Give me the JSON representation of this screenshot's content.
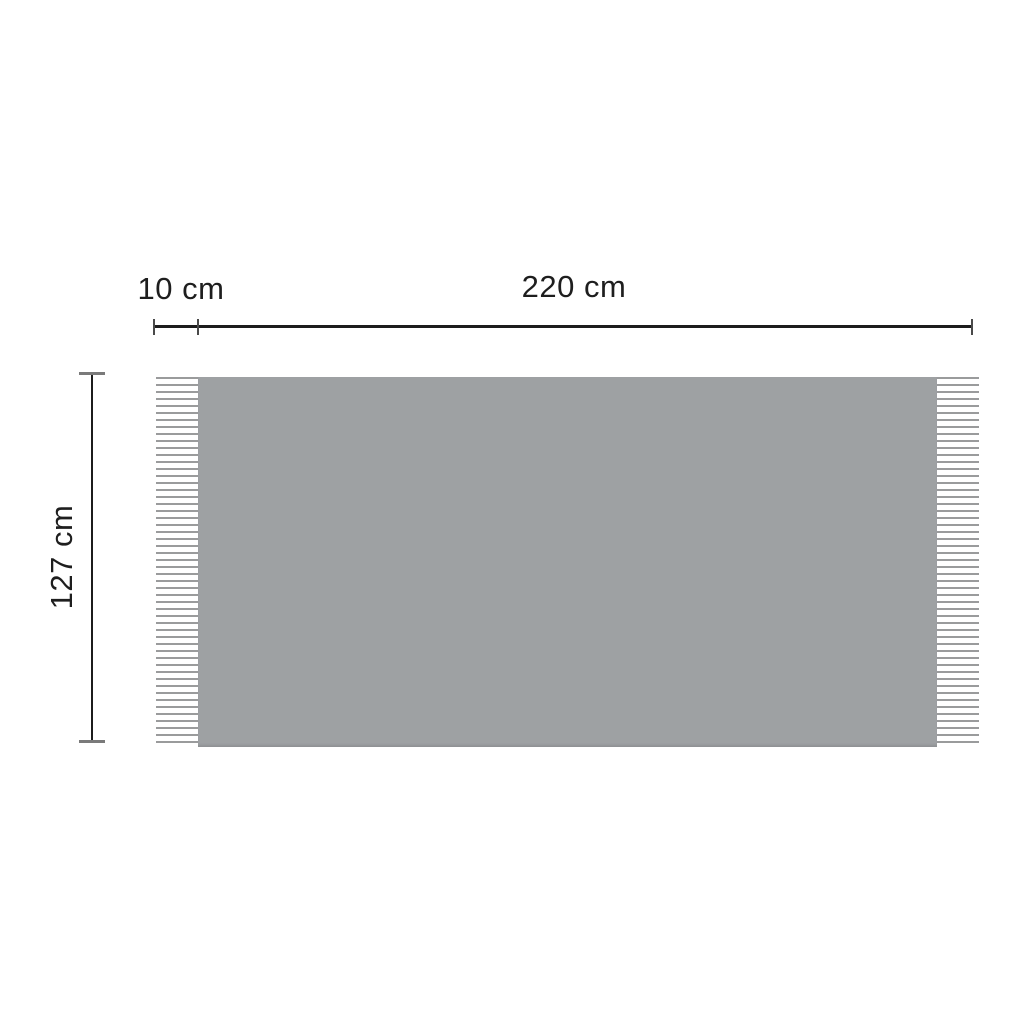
{
  "diagram": {
    "labels": {
      "fringe_width": "10 cm",
      "body_width": "220 cm",
      "height": "127 cm"
    }
  },
  "colors": {
    "bg": "#ffffff",
    "blanket": "#9ea1a3",
    "blanket-edge": "#8f9294",
    "fringe-line": "#9a9b9c",
    "dim-line": "#1c1c1c",
    "tick-dark": "#4a4a4a",
    "tick-gray": "#7a7a7a",
    "text": "#1e1e1e"
  }
}
